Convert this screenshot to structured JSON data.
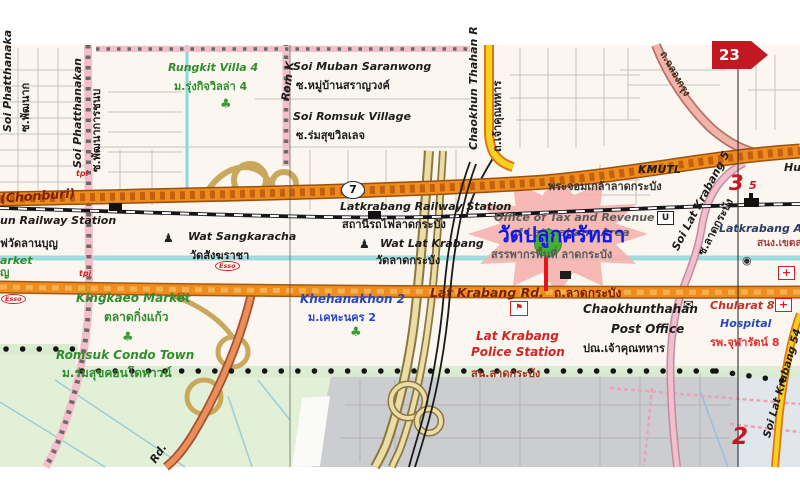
{
  "map": {
    "colors": {
      "highlight_blue": "#1515e8",
      "road_orange": "#ef8c1e",
      "marker_red": "#c41822",
      "marker_green": "#41b32c"
    },
    "labels": {
      "soi_phatthanaka": {
        "en": "Soi Phatthanaka",
        "th": "ซ.พัฒนาก"
      },
      "soi_phatthanakan": {
        "en": "Soi Phatthanakan",
        "th": "ซ.พัฒนาการชนบ"
      },
      "rom_k": {
        "en": "Rom K"
      },
      "rungkit_villa": {
        "en": "Rungkit Villa 4",
        "th": "ม.รุ่งกิจวิลล่า 4"
      },
      "muban_saranwong": {
        "en": "Soi Muban Saranwong",
        "th": "ซ.หมู่บ้านสราญวงค์"
      },
      "romsuk_village": {
        "en": "Soi Romsuk Village",
        "th": "ซ.ร่มสุขวิลเลจ"
      },
      "chaokhun_thahan": {
        "en": "Chaokhun Thahan R",
        "th": "ถ.เจ้าคุณทหาร"
      },
      "chalong_krung": {
        "th": "ถ.ฉลองกรุง"
      },
      "chonburi": {
        "en": "(Chonburi)"
      },
      "lanbun_station": {
        "en": "un Railway Station",
        "th": "ฟวัดลานบุญ"
      },
      "latkrabang_station": {
        "en": "Latkrabang Railway Station",
        "th": "สถานีรถไฟลาดกระบัง"
      },
      "wat_sangkaracha": {
        "en": "Wat Sangkaracha",
        "th": "วัดสังฆราชา"
      },
      "wat_lat_krabang": {
        "en": "Wat Lat Krabang",
        "th": "วัดลาดกระบัง"
      },
      "kmutl": {
        "en": "KMUTL",
        "th": "พระจอมเกล้าลาดกระบัง"
      },
      "tax_office": {
        "en1": "Office of Tax and Revenue",
        "en2": "of Latkrabang Area",
        "th": "สรรพากรพื้นที่ ลาดกระบัง"
      },
      "wat_pluk_satha": {
        "th": "วัดปลูกศรัทธา"
      },
      "soi_lat_krabang5": {
        "en": "Soi Lat Krabang 5",
        "th": "ซ.ลาดกระบัง"
      },
      "latkrabang_area": {
        "en": "Latkrabang Are",
        "th": "สนง.เขตลาดกระ"
      },
      "hu_partial": {
        "en": "Hu"
      },
      "market_partial": {
        "en": "arket",
        "th": "ญ"
      },
      "kingkaeo_market": {
        "en": "Kingkaeo Market",
        "th": "ตลาดกิ่งแก้ว"
      },
      "khehanakhon": {
        "en": "Khehanakhon 2",
        "th": "ม.เคหะนคร 2"
      },
      "lat_krabang_rd": {
        "en": "Lat Krabang Rd.",
        "th": "ถ.ลาดกระบัง"
      },
      "police": {
        "en1": "Lat Krabang",
        "en2": "Police Station",
        "th": "สน.ลาดกระบัง"
      },
      "post_office": {
        "en1": "Chaokhunthahan",
        "en2": "Post Office",
        "th": "ปณ.เจ้าคุณทหาร"
      },
      "chularat": {
        "en1": "Chularat 8",
        "en2": "Hospital",
        "th": "รพ.จุฬารัตน์ 8"
      },
      "romsuk_condo": {
        "en": "Romsuk Condo Town",
        "th": "ม.ร่มสุขคอนโดทาวน์"
      },
      "soi_lat_krabang54": {
        "en": "Soi Lat Krabang 54"
      },
      "rd_partial": {
        "en": "Rd."
      }
    },
    "markers": {
      "route7": "7",
      "route23": "23",
      "page3": "3",
      "page3_sub": "5",
      "page2": "2",
      "u_symbol": "U"
    },
    "icons": {
      "tree": "♣",
      "buddha": "♟",
      "market_scale": "⚖",
      "envelope": "✉",
      "police_flag": "⚑",
      "govt_dot": "◉",
      "hospital_cross": "+",
      "esso": "Esso",
      "tpi": "tpi"
    }
  }
}
